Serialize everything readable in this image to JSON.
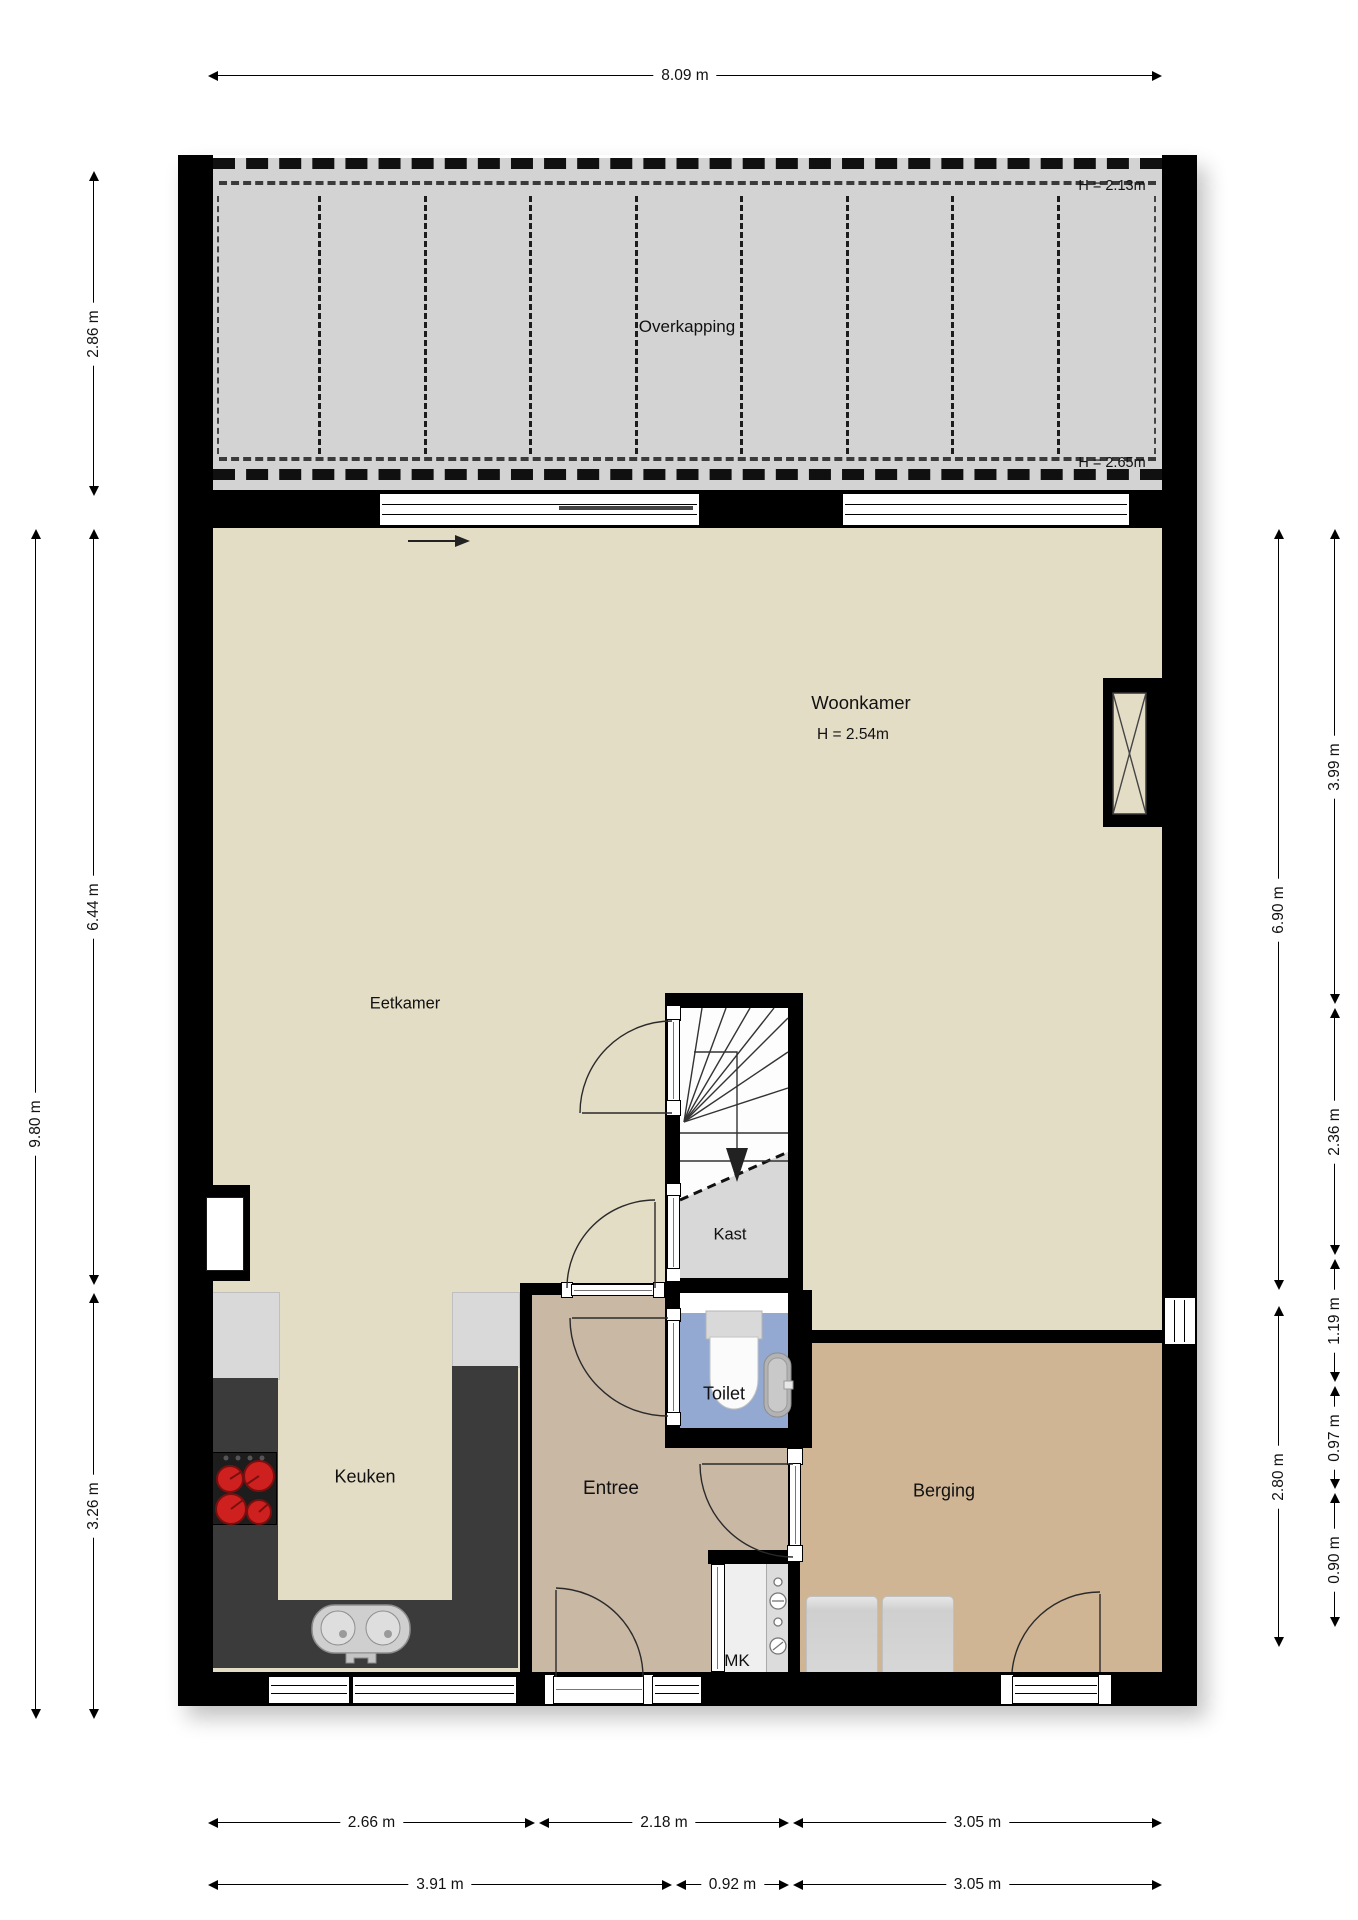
{
  "rooms": {
    "overkapping": {
      "name": "Overkapping",
      "h_front": "H = 2.13m",
      "h_back": "H = 2.65m"
    },
    "woonkamer": {
      "name": "Woonkamer",
      "h": "H = 2.54m"
    },
    "eetkamer": {
      "name": "Eetkamer"
    },
    "kast": {
      "name": "Kast"
    },
    "toilet": {
      "name": "Toilet"
    },
    "keuken": {
      "name": "Keuken"
    },
    "entree": {
      "name": "Entree"
    },
    "berging": {
      "name": "Berging"
    },
    "meterkast": {
      "name": "MK"
    }
  },
  "dimensions": {
    "top": {
      "buitenbreedte": "8.09 m"
    },
    "left": {
      "overkapping_diepte": "2.86 m",
      "woonkamer_diepte": "6.44 m",
      "totale_diepte": "9.80 m",
      "keuken_diepte": "3.26 m"
    },
    "right": {
      "woonkamer_boven": "3.99 m",
      "woonkamer_totaal": "6.90 m",
      "trap": "2.36 m",
      "toilet": "1.19 m",
      "gang": "0.97 m",
      "berging": "2.80 m",
      "deur": "0.90 m"
    },
    "bottom": {
      "keuken_breedte": "2.66 m",
      "entree_breedte": "2.18 m",
      "berging_breedte": "3.05 m",
      "keuken_totaal": "3.91 m",
      "gang_breedte": "0.92 m",
      "berging_totaal": "3.05 m"
    }
  },
  "colors": {
    "wall": "#000000",
    "floor_living": "#e4ddc6",
    "floor_entree": "#c9b8a4",
    "floor_berging": "#cfb594",
    "floor_toilet": "#93a9d1",
    "floor_overkapping": "#d3d3d3",
    "floor_kast": "#d8d8d8",
    "counter": "#3b3b3b",
    "burner": "#cf2020"
  }
}
